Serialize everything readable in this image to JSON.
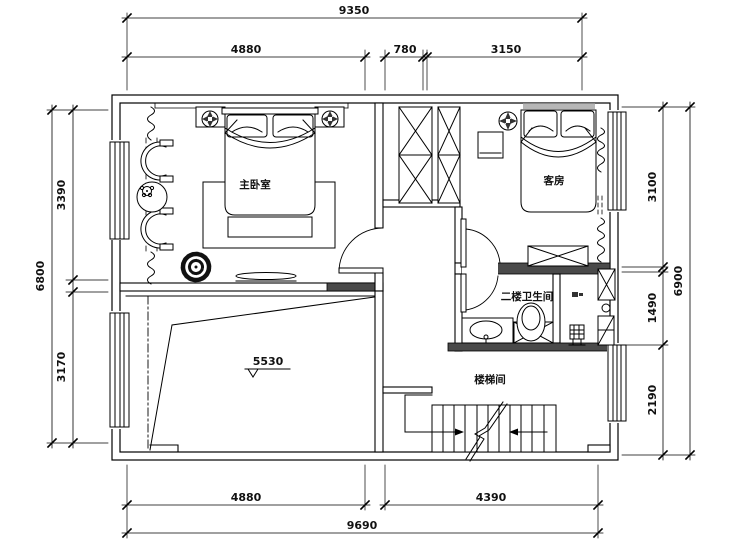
{
  "drawing": {
    "title": "second-floor-plan",
    "rooms": [
      {
        "id": "master_bedroom",
        "label": "主卧室"
      },
      {
        "id": "guest_room",
        "label": "客房"
      },
      {
        "id": "bathroom",
        "label": "二楼卫生间"
      },
      {
        "id": "stair_hall",
        "label": "楼梯间"
      }
    ],
    "dims": {
      "top_overall": "9350",
      "top_1": "4880",
      "top_2": "780",
      "top_3": "3150",
      "bottom_1": "4880",
      "bottom_2": "4390",
      "bottom_overall": "9690",
      "left_1": "3390",
      "left_2": "3170",
      "left_overall": "6800",
      "right_1": "3100",
      "right_2": "1490",
      "right_3": "2190",
      "right_overall": "6900",
      "elevation": "5530"
    },
    "symbols": [
      "elevation-marker",
      "stair-direction-arrows",
      "bed",
      "wardrobe-x",
      "toilet",
      "sink",
      "floor-drain",
      "armchair",
      "plant",
      "curtain"
    ],
    "colors": {
      "line": "#000000",
      "bg": "#ffffff",
      "wall_fill": "#4a4a4a",
      "niche_fill": "#999999"
    }
  }
}
